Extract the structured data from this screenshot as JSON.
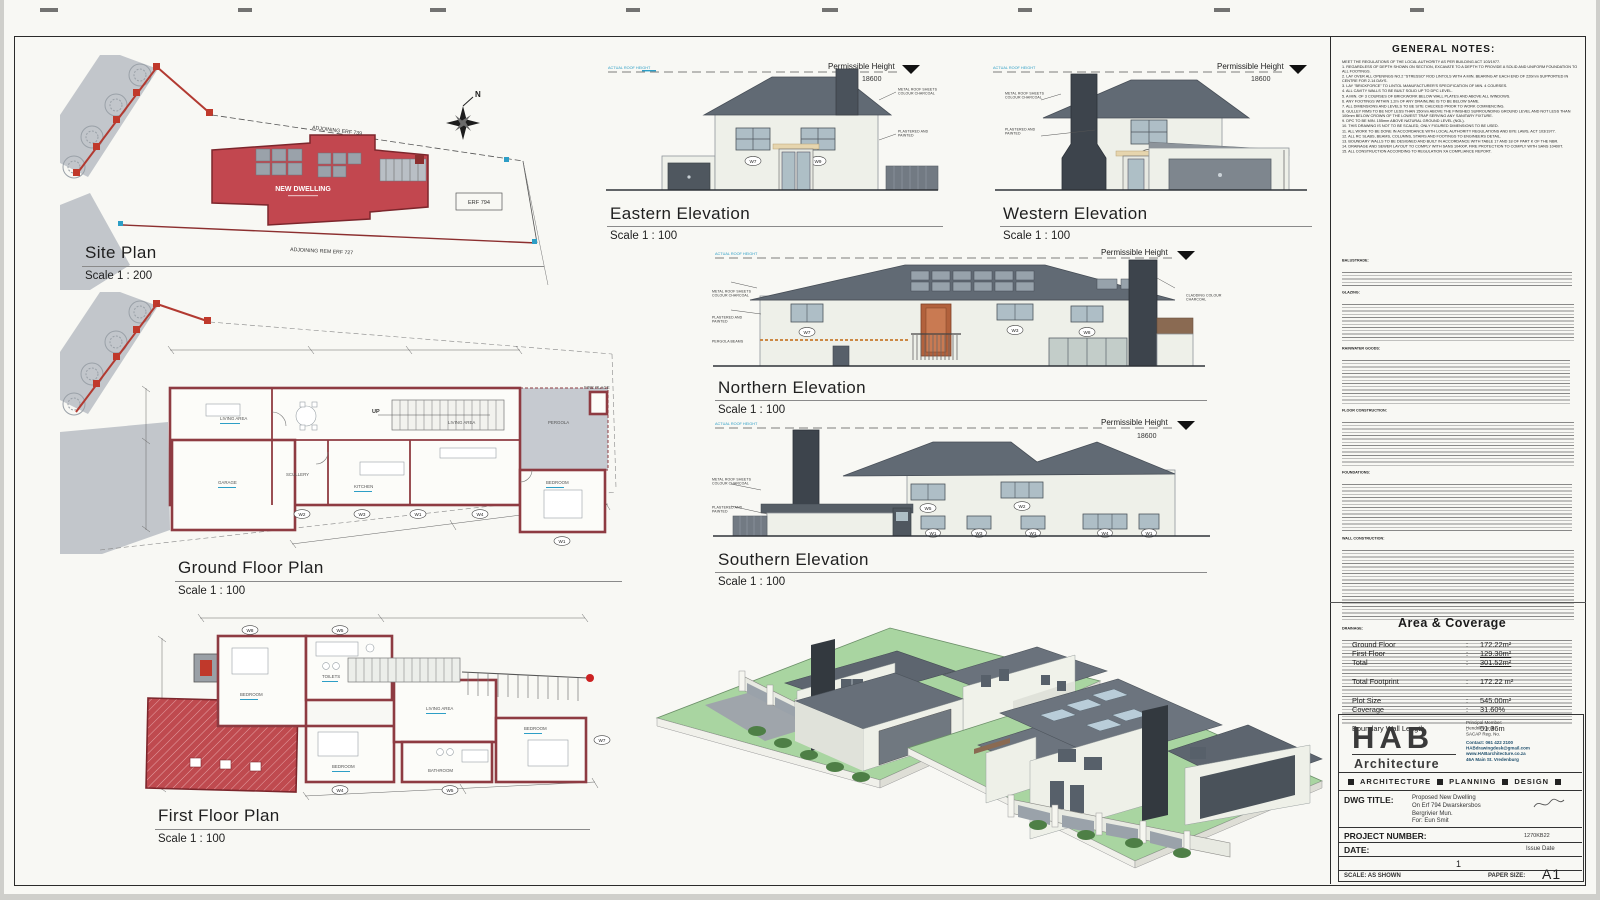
{
  "sheet": {
    "page_number": "1"
  },
  "site_plan": {
    "title": "Site Plan",
    "scale": "Scale 1 : 200",
    "adjoining_top": "ADJOINING ERF 739",
    "adjoining_bottom": "ADJOINING REM ERF 727",
    "erf_label": "ERF 794",
    "building_label": "NEW DWELLING",
    "north": "N"
  },
  "elevations": {
    "eastern": {
      "title": "Eastern Elevation",
      "scale": "Scale 1 : 100",
      "perm_label": "Permissible Height",
      "perm_value": "18600",
      "actual_label": "ACTUAL ROOF HEIGHT",
      "roof_note": "METAL ROOF SHEETS COLOUR CHARCOAL",
      "wall_note": "PLASTERED AND PAINTED",
      "w1": "W7",
      "w2": "W9"
    },
    "western": {
      "title": "Western Elevation",
      "scale": "Scale 1 : 100",
      "perm_label": "Permissible Height",
      "perm_value": "18600",
      "actual_label": "ACTUAL ROOF HEIGHT",
      "roof_note": "METAL ROOF SHEETS COLOUR CHARCOAL",
      "wall_note": "PLASTERED AND PAINTED",
      "w1": "W6"
    },
    "northern": {
      "title": "Northern Elevation",
      "scale": "Scale 1 : 100",
      "perm_label": "Permissible Height",
      "perm_value": "18600",
      "actual_label": "ACTUAL ROOF HEIGHT",
      "roof_note": "METAL ROOF SHEETS COLOUR CHARCOAL",
      "wall_note": "PLASTERED AND PAINTED",
      "pergola_note": "PERGOLA BEAMS",
      "cladding_note": "CLADDING COLOUR CHARCOAL",
      "w1": "W7",
      "w2": "W3",
      "w3": "W8"
    },
    "southern": {
      "title": "Southern Elevation",
      "scale": "Scale 1 : 100",
      "perm_label": "Permissible Height",
      "perm_value": "18600",
      "actual_label": "ACTUAL ROOF HEIGHT",
      "roof_note": "METAL ROOF SHEETS COLOUR CHARCOAL",
      "wall_note": "PLASTERED AND PAINTED",
      "w1": "W5",
      "w2": "W2",
      "w3": "W1",
      "w4": "W3",
      "w5": "W1",
      "w6": "W4",
      "w7": "W1"
    }
  },
  "plans": {
    "ground": {
      "title": "Ground Floor Plan",
      "scale": "Scale 1 : 100",
      "up": "UP",
      "living1": "LIVING AREA",
      "garage": "GARAGE",
      "scullery": "SCULLERY",
      "kitchen": "KITCHEN",
      "living2": "LIVING AREA",
      "bedroom": "BEDROOM",
      "pergola": "PERGOLA",
      "fireplace": "FIRE PLACE",
      "windows": [
        "W2",
        "W3",
        "W1",
        "W4",
        "W1"
      ]
    },
    "first": {
      "title": "First Floor Plan",
      "scale": "Scale 1 : 100",
      "bedroom1": "BEDROOM",
      "toilets": "TOILETS",
      "living": "LIVING AREA",
      "bathroom": "BATHROOM",
      "bedroom2": "BEDROOM",
      "bedroom3": "BEDROOM",
      "windows": [
        "W8",
        "W5",
        "W4",
        "W5",
        "W7"
      ]
    }
  },
  "general_notes": {
    "title": "GENERAL NOTES:",
    "intro": "MEET THE REGULATIONS OF THE LOCAL AUTHORITY AS PER BUILDING ACT 103/1977.",
    "items": [
      "1. REGARDLESS OF DEPTH SHOWN ON SECTION, EXCAVATE TO A DEPTH TO PROVIDE A SOLID AND UNIFORM FOUNDATION TO ALL FOOTINGS.",
      "2. LAY OVER ALL OPENINGS NO.2 \"STRESSO\" ROD LINTOLS WITH A MIN. BEARING AT EACH END OF 220mm SUPPORTED IN CENTRE FOR 2-14 DAYS.",
      "3. LAY \"BRICKFORCE\" TO LINTOL MANUFACTURER'S SPECIFICATION OF MIN. 4 COURSES.",
      "4. ALL CAVITY WALLS TO BE BUILT SOLID UP TO DPC LEVEL.",
      "5. A MIN. OF 3 COURSES OF BRICKWORK BELOW WALL PLATES AND ABOVE ALL WINDOWS.",
      "6. ANY FOOTINGS WITHIN 1.2m OF ANY DRAINLINE IS TO BE BELOW SAME.",
      "7. ALL DIMENSIONS AND LEVELS TO BE SITE CHECKED PRIOR TO WORK COMMENCING.",
      "8. GULLEY RIMS TO BE NOT LESS THAN 150mm ABOVE THE FINISHED SURROUNDING GROUND LEVEL AND NOT LESS THAN 100mm BELOW CROWN OF THE LOWEST TRAP SERVING ANY SANITARY FIXTURE.",
      "9. DPC TO BE MIN. 155mm ABOVE NATURAL GROUND LEVEL (NGL).",
      "10. THIS DRAWING IS NOT TO BE SCALED, ONLY FIGURED DIMENSIONS TO BE USED.",
      "11. ALL WORK TO BE DONE IN ACCORDANCE WITH LOCAL AUTHORITY REGULATIONS AND BYE LAWS, ACT 103/1977.",
      "12. ALL RC SLABS, BEAMS, COLUMNS, STAIRS AND FOOTINGS TO ENGINEERS DETAIL.",
      "13. BOUNDARY WALLS TO BE DESIGNED AND BUILT IN ACCORDANCE WITH TABLE 17 AND 18 OF PART K OF THE NBR.",
      "14. DRAINAGE AND SEWER LAYOUT TO COMPLY WITH SANS 10400P, FIRE PROTECTION TO COMPLY WITH SANS 10400T.",
      "15. ALL CONSTRUCTION ACCORDING TO REGULATION XA COMPLIANCE REPORT."
    ]
  },
  "spec_notes": {
    "sections": [
      "BALUSTRADE:",
      "GLAZING:",
      "RAINWATER GOODS:",
      "FLOOR CONSTRUCTION:",
      "FOUNDATIONS:",
      "WALL CONSTRUCTION:",
      "DRAINAGE:"
    ]
  },
  "area_coverage": {
    "title": "Area & Coverage",
    "sep": ":",
    "rows": [
      {
        "label": "Ground Floor",
        "value": "172.22m²"
      },
      {
        "label": "First Floor",
        "value": "129.30m²"
      },
      {
        "label": "Total",
        "value": "301.52m²"
      },
      {
        "label": "Total Footprint",
        "value": "172.22 m²"
      },
      {
        "label": "Plot Size",
        "value": "545.00m²"
      },
      {
        "label": "Coverage",
        "value": "31.60%"
      },
      {
        "label": "Boundary Wall Length",
        "value": "51.36m"
      }
    ]
  },
  "title_block": {
    "logo": "HAB",
    "logo_sub": "Architecture",
    "principal_l1": "Principal Member:",
    "principal_l2": "Hendrik Kandt",
    "principal_l3": "SACAP Reg. No.",
    "contact_l1": "Contact: 061 422 2100",
    "contact_l2": "HABdrawingdesk@gmail.com",
    "contact_l3": "www.HABarchitecture.co.za",
    "contact_l4": "46A Main St. Vredenburg",
    "svc1": "ARCHITECTURE",
    "svc2": "PLANNING",
    "svc3": "DESIGN",
    "dwg_label": "DWG TITLE:",
    "dwg_l1": "Proposed New Dwelling",
    "dwg_l2": "On Erf 794 Dwarskersbos",
    "dwg_l3": "Bergrivier Mun.",
    "dwg_l4": "For: Eun Smit",
    "proj_label": "PROJECT NUMBER:",
    "proj_value": "1270KB22",
    "date_label": "DATE:",
    "date_value": "Issue Date",
    "page": "1",
    "scale_text": "SCALE: AS SHOWN",
    "paper_label": "PAPER SIZE:",
    "paper_value": "A1"
  }
}
